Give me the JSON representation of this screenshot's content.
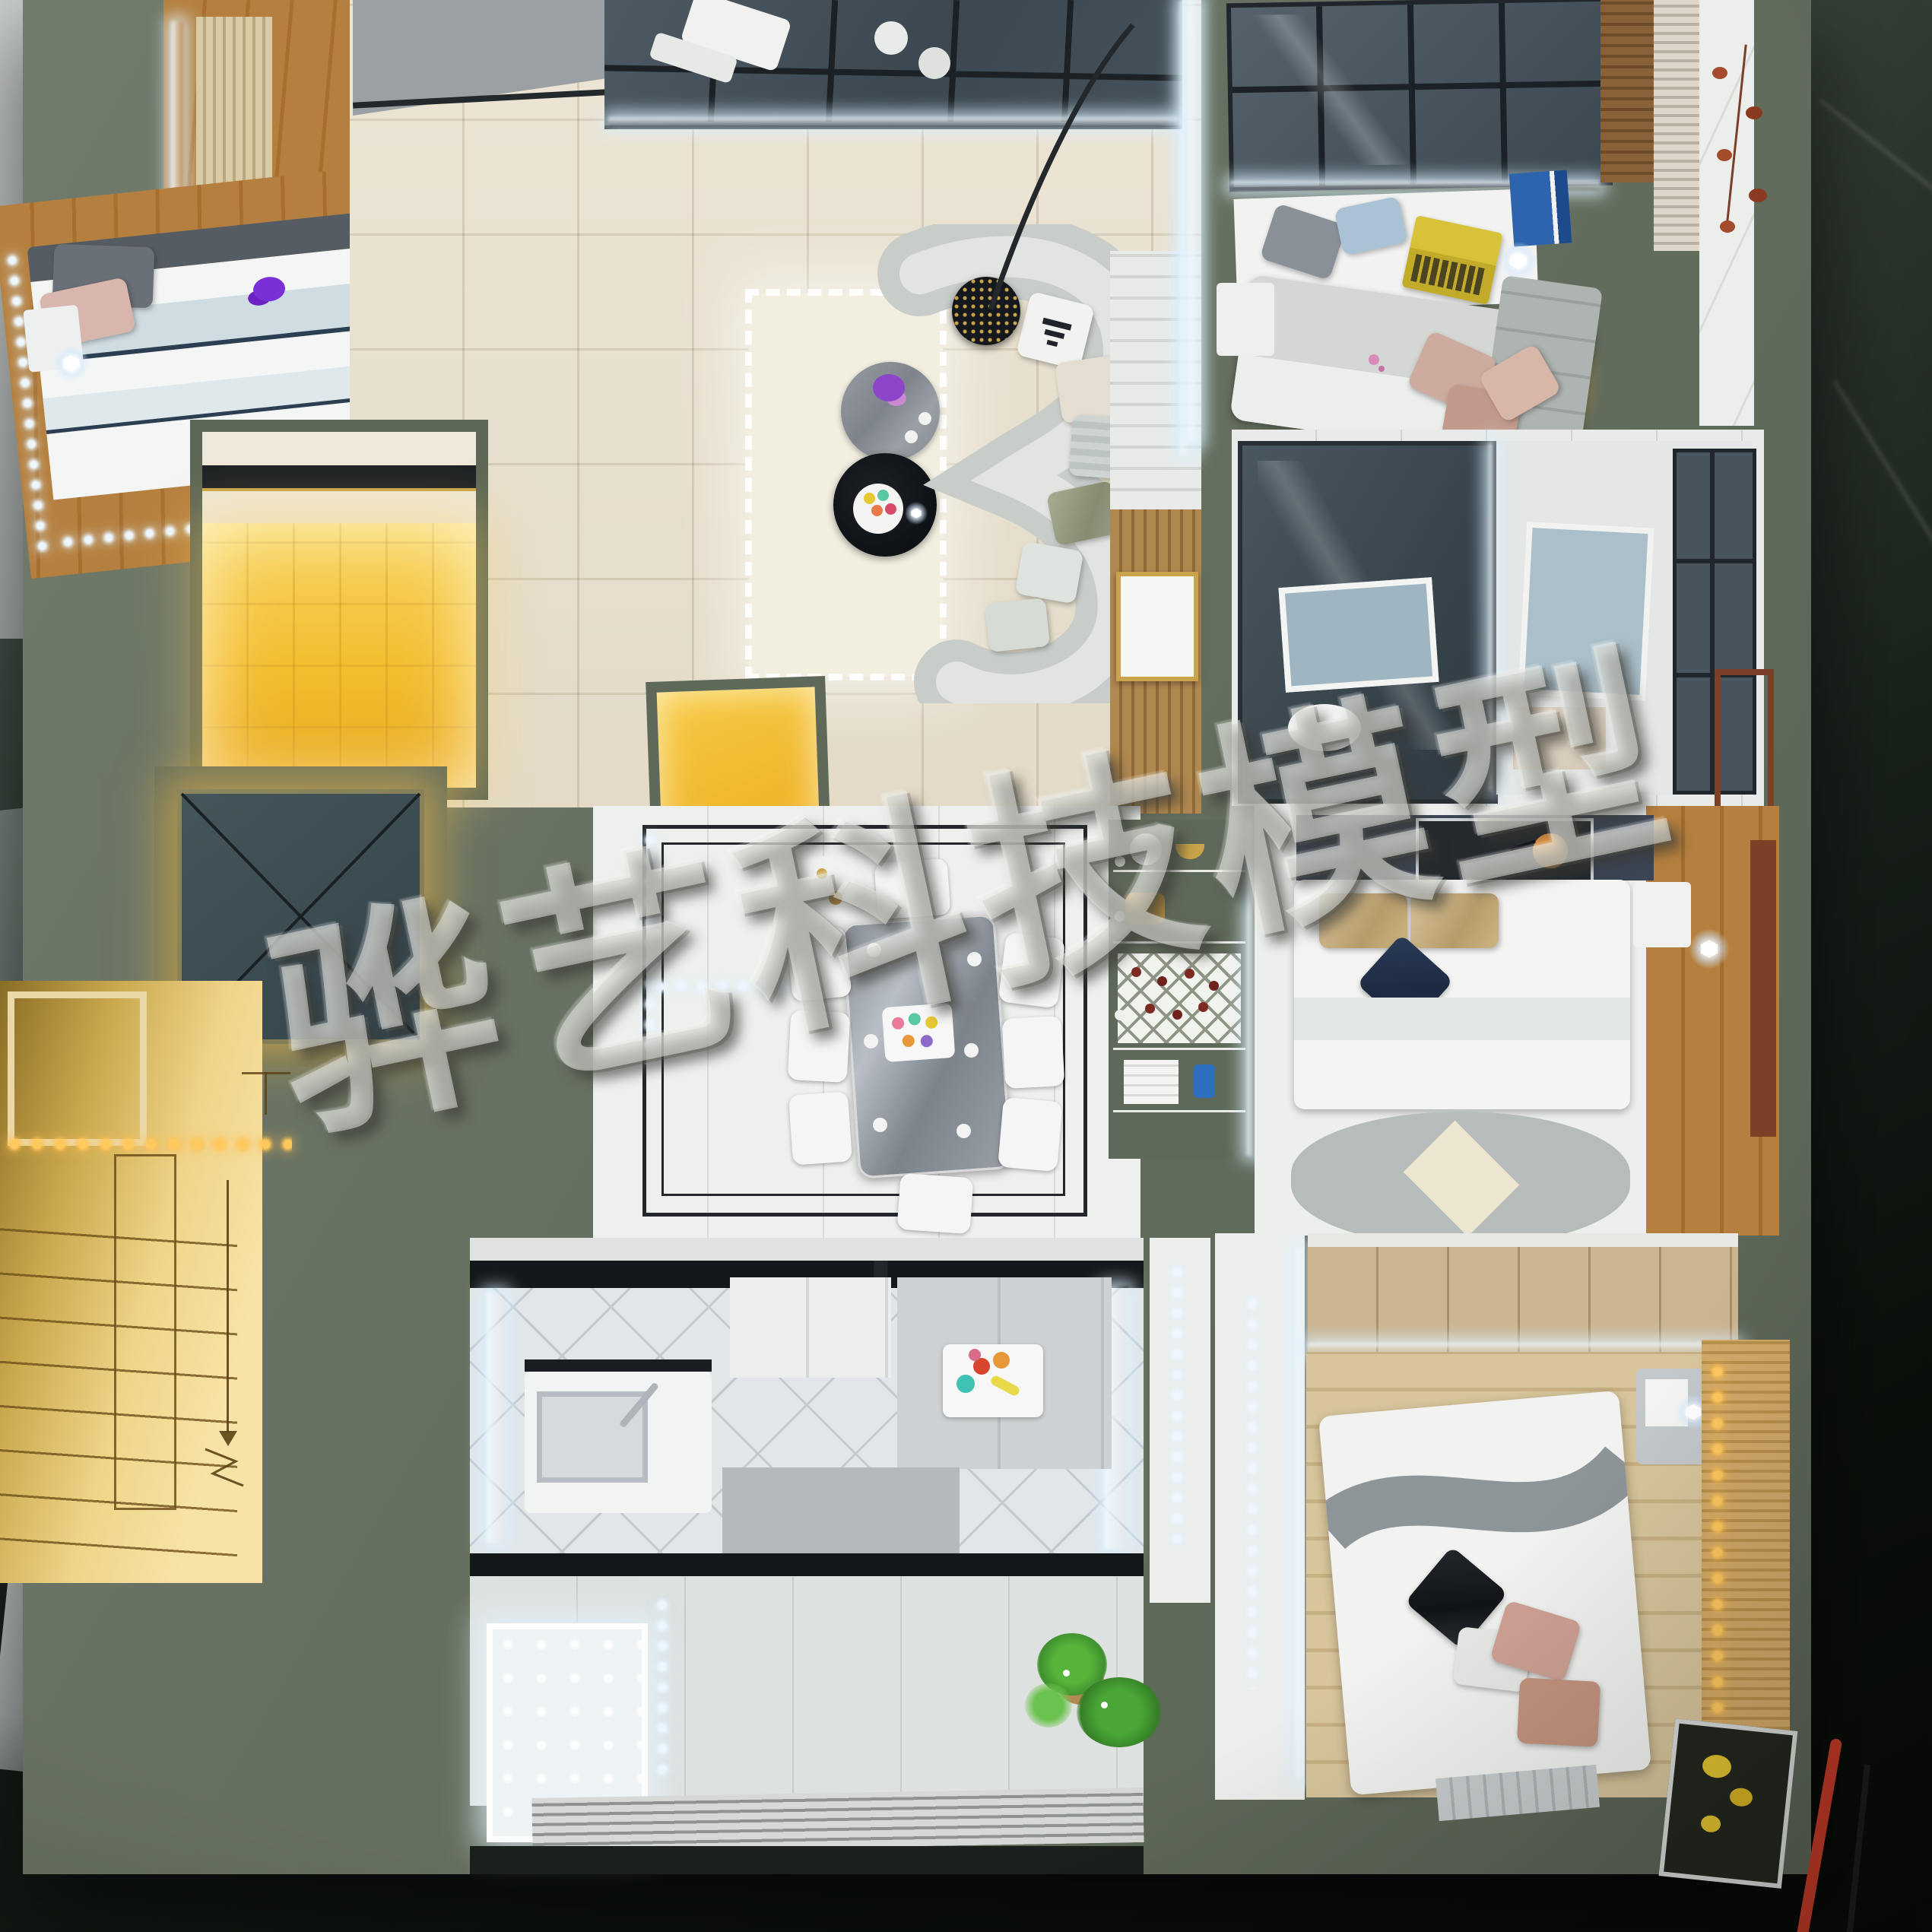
{
  "image": {
    "type": "photograph",
    "subject": "top-down view of an illuminated apartment scale model on a dark green marble table"
  },
  "watermark": {
    "text": "骅艺科技模型"
  },
  "study": {
    "monitor_text": "Windows 7"
  },
  "palette": {
    "olive": "#6d7767",
    "oliveDark": "#5d675a",
    "warmYellow": "#f4bd2f",
    "warmGlow": "#ffe9a6",
    "ledWhite": "#eef7ff",
    "ledWarm": "#ffc95e",
    "floorBeige": "#e9e2d2",
    "marbleWhite": "#eef0ee",
    "inlayBlack": "#23272b",
    "wood": "#b0803f",
    "woodLight": "#d8c59b",
    "glass": "#45525a",
    "monitorBlue": "#1e72d4",
    "sofa": "#c8cdc9",
    "rug": "#f2eee0",
    "gold": "#c9a44a",
    "leafGreen": "#4aa636",
    "leafRust": "#a34b2a",
    "cableRed": "#c13826"
  }
}
